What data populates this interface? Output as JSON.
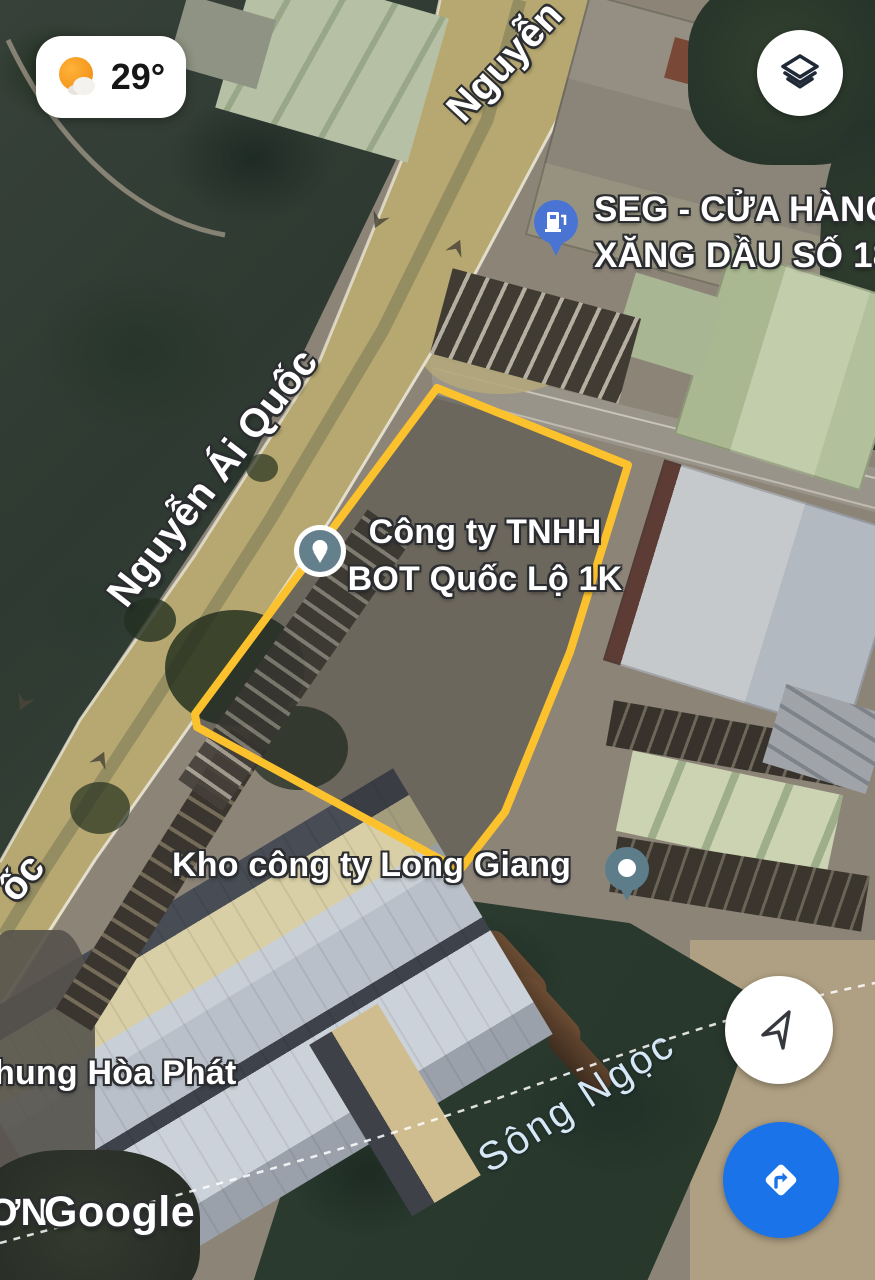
{
  "app": "google-maps-satellite-view",
  "weather_chip": {
    "temperature": "29°",
    "icon": "sun-behind-cloud-icon"
  },
  "controls": {
    "layers_button": {
      "icon": "layers-icon"
    },
    "my_location_button": {
      "icon": "navigation-arrow-icon"
    },
    "directions_button": {
      "icon": "directions-turn-icon",
      "color": "#1a73e8"
    }
  },
  "map_labels": {
    "road_label_top_partial": "Nguyễn",
    "road_label_main": "Nguyễn Ái Quốc",
    "road_label_left_partial": "ốc",
    "gas_station_line1": "SEG - CỬA HÀNG",
    "gas_station_line2": "XĂNG DẦU SỐ 18",
    "company_line1": "Công ty TNHH",
    "company_line2": "BOT Quốc Lộ 1K",
    "warehouse_company": "Kho công ty Long Giang",
    "factory_partial": "hung Hòa Phát",
    "river": "Sông Ngọc",
    "cutoff_label_partial": "ƠN",
    "attribution": "Google"
  },
  "markers": {
    "gas_station_pin": {
      "icon": "gas-pump-pin-icon",
      "color": "#4a74d3"
    },
    "company_marker": {
      "icon": "place-pin-circle-icon",
      "color": "#64808d"
    },
    "warehouse_marker": {
      "icon": "dot-circle-marker-icon",
      "color": "#5e7d8a"
    }
  },
  "overlays": {
    "property_outline_color": "#fcc22d",
    "boundary_line_style": "white-dashed",
    "river_label_color": "#d6e7f6"
  }
}
